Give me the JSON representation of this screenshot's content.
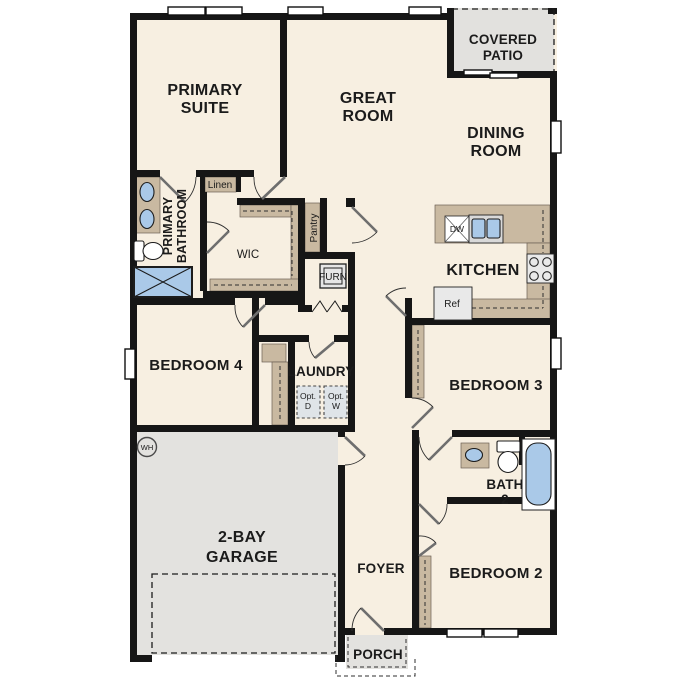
{
  "title": "Floor plan",
  "labels": {
    "primary_suite": [
      "PRIMARY",
      "SUITE"
    ],
    "great_room": [
      "GREAT",
      "ROOM"
    ],
    "covered_patio": [
      "COVERED",
      "PATIO"
    ],
    "dining_room": [
      "DINING",
      "ROOM"
    ],
    "kitchen": [
      "KITCHEN"
    ],
    "primary_bathroom": [
      "PRIMARY",
      "BATHROOM"
    ],
    "wic": [
      "WIC"
    ],
    "linen_primary": [
      "Linen"
    ],
    "linen_hall": [
      "Linen"
    ],
    "pantry": [
      "Pantry"
    ],
    "furnace": [
      "FURN"
    ],
    "dishwasher": [
      "DW"
    ],
    "refrigerator": [
      "Ref"
    ],
    "bedroom4": [
      "BEDROOM 4"
    ],
    "laundry": [
      "LAUNDRY"
    ],
    "opt_dryer": [
      "Opt.",
      "D"
    ],
    "opt_washer": [
      "Opt.",
      "W"
    ],
    "water_heater": [
      "WH"
    ],
    "garage": [
      "2-BAY",
      "GARAGE"
    ],
    "bedroom3": [
      "BEDROOM 3"
    ],
    "bath2": [
      "BATH",
      "2"
    ],
    "bedroom2": [
      "BEDROOM 2"
    ],
    "foyer": [
      "FOYER"
    ],
    "porch": [
      "PORCH"
    ]
  },
  "colors": {
    "wall": "#161616",
    "floor": "#f7efe1",
    "garage_gray": "#e3e2df",
    "patio_gray": "#e2e1de",
    "casework": "#c9b9a1",
    "fixture_blue": "#aac9e8",
    "appliance": "#e9e9e9",
    "opt_box": "#dfe4e8"
  }
}
